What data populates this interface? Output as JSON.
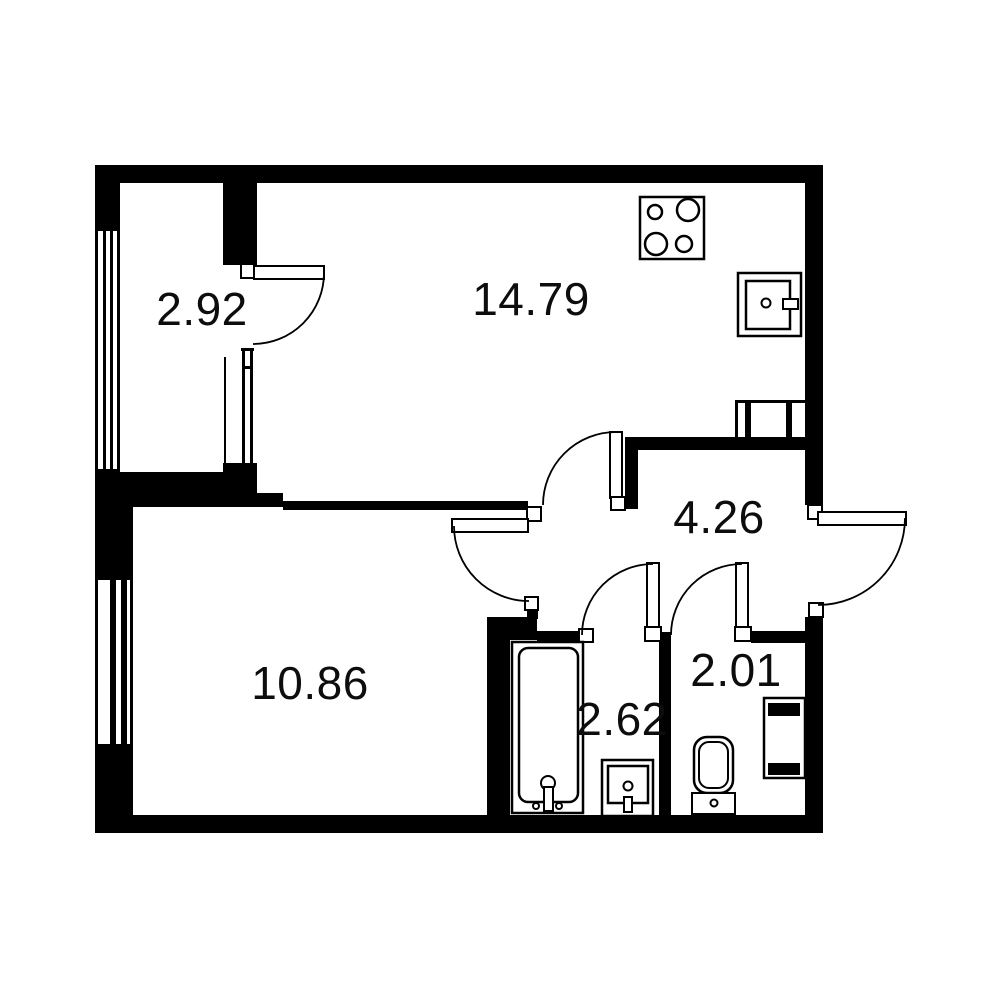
{
  "title": "Apartment floor plan",
  "colors": {
    "wall": "#000000",
    "line": "#000000",
    "label": "#0d0d0d",
    "background": "#ffffff"
  },
  "rooms": [
    {
      "id": "room-top-left",
      "area": "2.92"
    },
    {
      "id": "kitchen-living",
      "area": "14.79"
    },
    {
      "id": "hallway",
      "area": "4.26"
    },
    {
      "id": "bedroom",
      "area": "10.86"
    },
    {
      "id": "bathroom",
      "area": "2.62"
    },
    {
      "id": "wc",
      "area": "2.01"
    }
  ],
  "fixtures": [
    "stove-icon",
    "kitchen-sink-icon",
    "vent-shaft-icon",
    "bathtub-icon",
    "washbasin-icon",
    "toilet-icon",
    "radiator-icon"
  ],
  "doors": [
    "door-room-top-left",
    "door-kitchen",
    "door-bedroom",
    "door-bathroom",
    "door-wc",
    "entrance-door"
  ],
  "windows": [
    "window-room-top-left",
    "window-bedroom",
    "partition-window"
  ]
}
